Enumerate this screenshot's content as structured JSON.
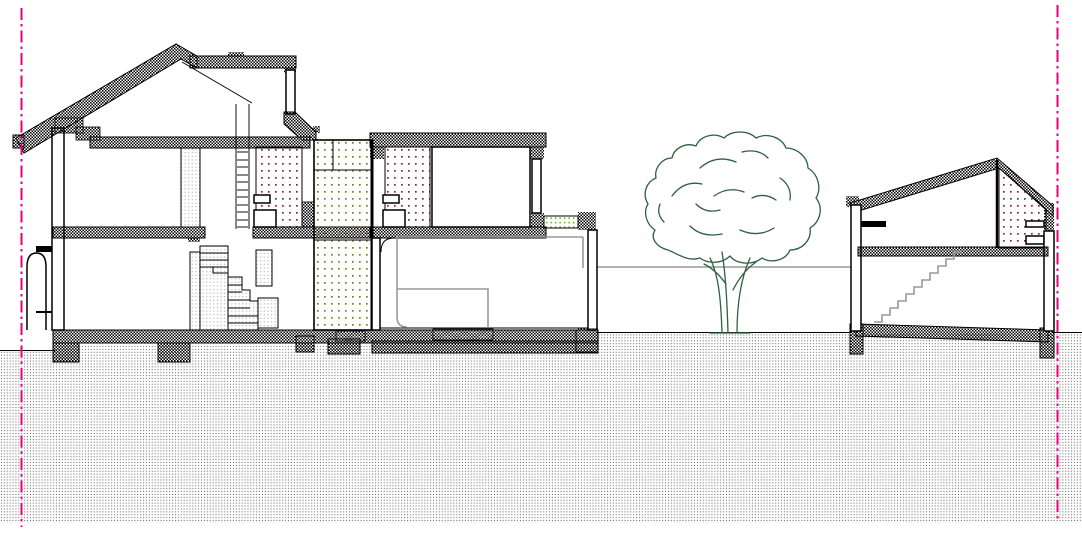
{
  "drawing": {
    "kind": "architectural cross-section / street elevation",
    "elements": {
      "left_boundary": "site boundary line (dash-dot)",
      "right_boundary": "site boundary line (dash-dot)",
      "main_house": "two-storey house section with attic, ladder, staircase and garage wing",
      "garden_wall": "low wall line between buildings",
      "tree": "garden tree in elevation",
      "neighbour_house": "single-bay house section with stair",
      "ground": "hatched ground / soil"
    }
  },
  "colors": {
    "line": "#000000",
    "boundary": "#e6007e",
    "tree": "#2d6040",
    "gray_detail": "#999999",
    "ground_dot": "#6e6e6e",
    "stipple_dot": "#9a9a9a",
    "red_dot": "#8a2433",
    "olive_dot": "#7d7d1e",
    "green_dot": "#5faa28"
  }
}
